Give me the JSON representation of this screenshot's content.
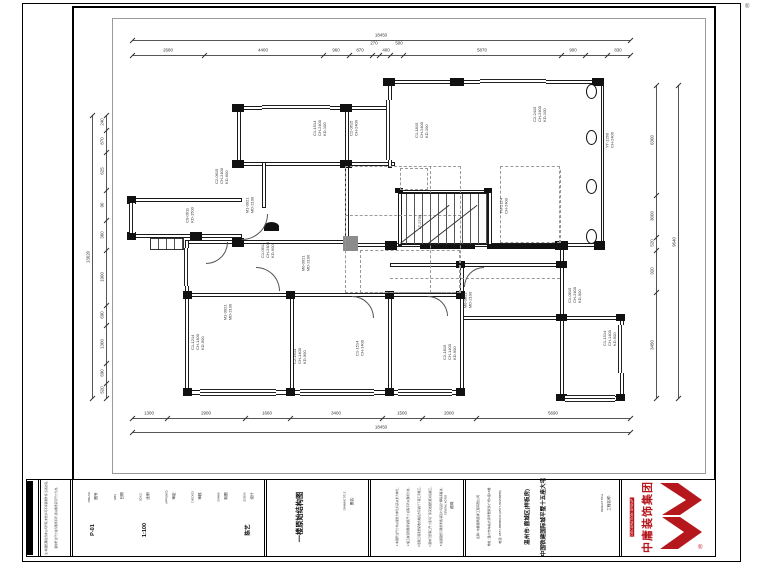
{
  "sheet": {
    "reg": "®"
  },
  "title_block": {
    "attributes": [
      {
        "label": "图号",
        "sublabel": "DWG.NO.",
        "value": "P-01"
      },
      {
        "label": "日期",
        "sublabel": "DATE",
        "value": ""
      },
      {
        "label": "比例",
        "sublabel": "SCALE",
        "value": "1:100"
      },
      {
        "label": "审定",
        "sublabel": "APPROVED",
        "value": ""
      },
      {
        "label": "审核",
        "sublabel": "CHECKED",
        "value": ""
      },
      {
        "label": "制图",
        "sublabel": "DRAWN",
        "value": ""
      },
      {
        "label": "设计",
        "sublabel": "DESIGN",
        "value": "陈艺"
      }
    ],
    "drawing_cell": {
      "label": "图名:",
      "sublabel": "DRAWING TITLE",
      "value": "一楼原始结构图"
    },
    "notes_cell": {
      "label": "说明:",
      "sublabel": "GENERAL NOTES",
      "lines": [
        "1.本图所注尺寸均以毫米为单位,标高以米为单位。",
        "2.施工前须到现场复核尺寸,如有不符以现场为准。",
        "3.隐蔽工程须经验收合格后方可进行下道工序施工。",
        "4.图中门窗洞口尺寸须与厂家深化图纸核对后施工。",
        "5.如遇图纸与现场矛盾,请及时与设计师联系解决。"
      ]
    },
    "project_cell": {
      "label": "工程名称:",
      "sublabel": "PROJECT TITLE",
      "info_lines": [
        "名称: 中庸建筑装饰工程有限公司",
        "地址: 温州市车站大道华盟商务广场A座16楼",
        "电话: 0577-88880233  (0577-80155888)"
      ],
      "big_lines": [
        "中国铁建国际城平墅十五座大宅",
        "温州市·鹿城区(样板房)"
      ]
    },
    "side_notes": [
      "注:本图纸版权归本公司所有,未经许可不得复制外传,违者必究。",
      "图中所注尺寸如与现场不符,须以现场实际尺寸为准。"
    ],
    "logo": {
      "name": "中庸装饰集团",
      "sub": "DECORATION GROUP",
      "reg": "®",
      "color": "#b5171d"
    }
  },
  "plan": {
    "walls": [
      [
        388,
        80,
        216,
        4
      ],
      [
        237,
        106,
        155,
        4
      ],
      [
        237,
        162,
        158,
        4
      ],
      [
        130,
        198,
        112,
        4
      ],
      [
        130,
        234,
        112,
        4
      ],
      [
        185,
        240,
        164,
        4
      ],
      [
        345,
        243,
        259,
        4
      ],
      [
        185,
        293,
        279,
        4
      ],
      [
        390,
        263,
        174,
        4
      ],
      [
        460,
        316,
        164,
        4
      ],
      [
        185,
        390,
        279,
        5
      ],
      [
        560,
        396,
        64,
        5
      ],
      [
        398,
        190,
        94,
        3
      ],
      [
        388,
        80,
        4,
        88
      ],
      [
        601,
        80,
        3,
        167
      ],
      [
        237,
        106,
        4,
        60
      ],
      [
        345,
        106,
        4,
        141
      ],
      [
        130,
        198,
        4,
        40
      ],
      [
        185,
        240,
        4,
        155
      ],
      [
        290,
        293,
        4,
        101
      ],
      [
        388,
        293,
        4,
        101
      ],
      [
        460,
        263,
        4,
        132
      ],
      [
        560,
        243,
        4,
        157
      ],
      [
        620,
        316,
        4,
        84
      ],
      [
        398,
        190,
        4,
        56
      ],
      [
        488,
        190,
        4,
        56
      ],
      [
        262,
        162,
        4,
        46
      ]
    ],
    "solids": [
      [
        383,
        78,
        12,
        8
      ],
      [
        450,
        78,
        14,
        8
      ],
      [
        592,
        78,
        12,
        8
      ],
      [
        232,
        104,
        12,
        8
      ],
      [
        340,
        104,
        12,
        8
      ],
      [
        232,
        160,
        12,
        8
      ],
      [
        340,
        160,
        12,
        8
      ],
      [
        127,
        196,
        9,
        8
      ],
      [
        127,
        232,
        9,
        8
      ],
      [
        190,
        232,
        12,
        8
      ],
      [
        232,
        238,
        12,
        9
      ],
      [
        385,
        241,
        12,
        9
      ],
      [
        420,
        244,
        55,
        5
      ],
      [
        487,
        244,
        78,
        5
      ],
      [
        555,
        241,
        13,
        9
      ],
      [
        594,
        241,
        11,
        9
      ],
      [
        183,
        291,
        9,
        8
      ],
      [
        286,
        291,
        9,
        8
      ],
      [
        385,
        291,
        9,
        8
      ],
      [
        456,
        291,
        9,
        8
      ],
      [
        456,
        261,
        9,
        7
      ],
      [
        556,
        261,
        11,
        7
      ],
      [
        183,
        388,
        9,
        8
      ],
      [
        286,
        388,
        9,
        8
      ],
      [
        385,
        388,
        9,
        8
      ],
      [
        456,
        388,
        9,
        8
      ],
      [
        556,
        314,
        11,
        7
      ],
      [
        616,
        314,
        9,
        7
      ],
      [
        556,
        394,
        11,
        7
      ],
      [
        616,
        394,
        9,
        7
      ],
      [
        395,
        188,
        8,
        5
      ],
      [
        484,
        188,
        8,
        5
      ]
    ],
    "grays": [
      [
        343,
        236,
        15,
        15
      ]
    ],
    "domes": [
      [
        264,
        222,
        15,
        9
      ]
    ],
    "windows_h": [
      [
        480,
        79,
        66,
        6
      ],
      [
        262,
        105,
        68,
        6
      ],
      [
        200,
        389,
        76,
        7
      ],
      [
        300,
        389,
        74,
        7
      ],
      [
        398,
        389,
        54,
        7
      ],
      [
        565,
        395,
        50,
        7
      ]
    ],
    "windows_v": [
      [
        386,
        100,
        6,
        60
      ],
      [
        129,
        203,
        6,
        30
      ],
      [
        184,
        248,
        6,
        38
      ],
      [
        618,
        325,
        6,
        48
      ]
    ],
    "steps": [
      [
        150,
        238,
        34,
        12
      ]
    ],
    "dboxes": [
      [
        345,
        166,
        116,
        127
      ],
      [
        500,
        166,
        60,
        77
      ],
      [
        400,
        168,
        28,
        22
      ],
      [
        360,
        250,
        100,
        43
      ]
    ],
    "dlv": [
      [
        430,
        166,
        127
      ],
      [
        560,
        170,
        73
      ]
    ],
    "dlh": [
      [
        345,
        215,
        116
      ],
      [
        390,
        278,
        170
      ]
    ],
    "arcs": [
      [
        242,
        214,
        26,
        "br"
      ],
      [
        256,
        267,
        24,
        "tr"
      ],
      [
        352,
        296,
        22,
        "tr"
      ],
      [
        428,
        296,
        20,
        "tr"
      ],
      [
        464,
        267,
        20,
        "tl"
      ],
      [
        206,
        242,
        22,
        "br"
      ]
    ],
    "ovals": [
      [
        586,
        84
      ],
      [
        586,
        130
      ],
      [
        586,
        179
      ],
      [
        586,
        229
      ]
    ],
    "stair": [
      398,
      193,
      90,
      52
    ],
    "slines": [
      [
        400,
        243,
        62,
        -38
      ],
      [
        428,
        243,
        62,
        -38
      ]
    ],
    "labels": [
      {
        "x": 222,
        "y": 176,
        "t": "C2-0615\nCH-2400\nKD-600"
      },
      {
        "x": 250,
        "y": 205,
        "t": "M1-0921\nMD-2100"
      },
      {
        "x": 268,
        "y": 250,
        "t": "C1-0612\nCH-2400\nKD-900"
      },
      {
        "x": 306,
        "y": 263,
        "t": "M0-0921\nMD-2100"
      },
      {
        "x": 320,
        "y": 128,
        "t": "C1-1514\nCH-2400\nKD-100"
      },
      {
        "x": 354,
        "y": 128,
        "t": "C2-0615\nCH-2400"
      },
      {
        "x": 422,
        "y": 130,
        "t": "C1-1815\nCH-2400\nKD-100"
      },
      {
        "x": 540,
        "y": 114,
        "t": "C2-2415\nCH-2400\nKD-100"
      },
      {
        "x": 504,
        "y": 206,
        "t": "TM-2124\nCH-2400"
      },
      {
        "x": 575,
        "y": 295,
        "t": "C1-0615\nCH-2400\nKD-900"
      },
      {
        "x": 610,
        "y": 338,
        "t": "C1-1514\nCH-1400\nKD-900"
      },
      {
        "x": 450,
        "y": 352,
        "t": "C2-1815\nCH-1400\nKD-900"
      },
      {
        "x": 360,
        "y": 348,
        "t": "C1-1514\nCH-1400"
      },
      {
        "x": 300,
        "y": 356,
        "t": "C2-1514\nCH-1400\nKD-900"
      },
      {
        "x": 228,
        "y": 312,
        "t": "M1-0921\nMD-2100"
      },
      {
        "x": 198,
        "y": 342,
        "t": "C1-1214\nCH-1400\nKD-900"
      },
      {
        "x": 420,
        "y": 222,
        "t": "LT-2730"
      },
      {
        "x": 610,
        "y": 140,
        "t": "YT-1260\nCH-2400"
      },
      {
        "x": 468,
        "y": 300,
        "t": "M0-0821\nMD-2100"
      },
      {
        "x": 190,
        "y": 215,
        "t": "C0-0611\nKD-1500"
      }
    ],
    "dims": {
      "top": {
        "line_y": 55,
        "overall_y": 40,
        "x1": 132,
        "x2": 630,
        "overall": "18450",
        "ticks": [
          132,
          204,
          323,
          349,
          372,
          379,
          390,
          403,
          561,
          585,
          607,
          630
        ],
        "labels": [
          [
            "2680",
            168,
            0
          ],
          [
            "4400",
            263,
            0
          ],
          [
            "960",
            336,
            0
          ],
          [
            "870",
            360,
            0
          ],
          [
            "270",
            374,
            -7
          ],
          [
            "400",
            386,
            0
          ],
          [
            "500",
            399,
            -7
          ],
          [
            "5870",
            482,
            0
          ],
          [
            "900",
            573,
            0
          ],
          [
            "830",
            618,
            0
          ]
        ]
      },
      "bottom": {
        "line_y": 418,
        "overall_y": 432,
        "x1": 132,
        "x2": 630,
        "overall": "18450",
        "ticks": [
          132,
          167,
          245,
          290,
          382,
          422,
          476,
          630
        ],
        "labels": [
          [
            "1300",
            149,
            0
          ],
          [
            "2900",
            206,
            0
          ],
          [
            "1660",
            267,
            0
          ],
          [
            "3400",
            336,
            0
          ],
          [
            "1500",
            402,
            0
          ],
          [
            "2000",
            449,
            0
          ],
          [
            "5690",
            553,
            0
          ]
        ]
      },
      "left": {
        "line_x": 106,
        "overall_x": 92,
        "y1": 115,
        "y2": 398,
        "overall": "13620",
        "ticks": [
          115,
          130,
          152,
          190,
          220,
          250,
          305,
          325,
          363,
          383,
          398
        ],
        "labels": [
          [
            "240",
            122
          ],
          [
            "870",
            141
          ],
          [
            "625",
            171
          ],
          [
            "90",
            205
          ],
          [
            "360",
            235
          ],
          [
            "1900",
            277
          ],
          [
            "690",
            315
          ],
          [
            "1300",
            344
          ],
          [
            "690",
            373
          ],
          [
            "520",
            390
          ]
        ]
      },
      "right": {
        "line_x": 656,
        "overall_x": 678,
        "y1": 85,
        "y2": 398,
        "overall": "9640",
        "ticks": [
          85,
          195,
          237,
          250,
          292,
          398
        ],
        "labels": [
          [
            "6300",
            140
          ],
          [
            "3000",
            216
          ],
          [
            "520",
            243
          ],
          [
            "920",
            271
          ],
          [
            "3450",
            345
          ]
        ]
      }
    }
  }
}
